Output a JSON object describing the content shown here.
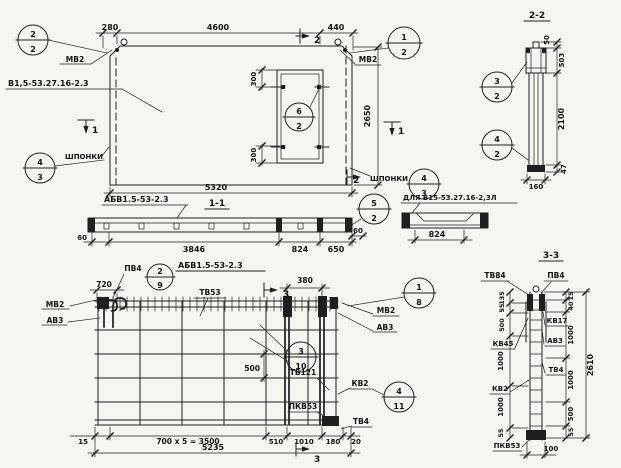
{
  "colors": {
    "ink": "#1f1f1f",
    "paper": "#f6f5f0"
  },
  "plan": {
    "dims": {
      "top_left": "280",
      "top_main": "4600",
      "top_right": "440",
      "right": "2650",
      "bottom": "5320",
      "opening_top": "300",
      "opening_bottom": "300"
    },
    "labels": {
      "anchor_left": "МВ2",
      "anchor_right": "МВ2",
      "panel_mark": "В1,5-53.27.16-2.3",
      "keys_left": "ШПОНКИ",
      "keys_right": "ШПОНКИ"
    },
    "callouts": {
      "top_left": {
        "num": "2",
        "den": "2"
      },
      "top_right": {
        "num": "1",
        "den": "2"
      },
      "keys_left": {
        "num": "4",
        "den": "3"
      },
      "keys_right": {
        "num": "4",
        "den": "3"
      },
      "opening": {
        "num": "6",
        "den": "2"
      }
    },
    "section_marks": {
      "s1": "1",
      "s2": "2"
    }
  },
  "section22": {
    "title": "2-2",
    "dims": {
      "loop": "50",
      "head": "503",
      "stem": "2100",
      "base": "47",
      "width": "160"
    },
    "callouts": {
      "upper": {
        "num": "3",
        "den": "2"
      },
      "lower": {
        "num": "4",
        "den": "2"
      }
    }
  },
  "section11": {
    "title": "1-1",
    "member_mark": "АБВ1.5-53-2.3",
    "dims": {
      "end_left": "60",
      "main": "3846",
      "mid": "824",
      "right_part": "650",
      "end_right": "60"
    },
    "callout": {
      "num": "5",
      "den": "2"
    }
  },
  "detail824": {
    "label": "ДЛЯ В15-53.27.16-2,3Л",
    "dim": "824"
  },
  "reinf": {
    "title": "АБВ1.5-53-2.3",
    "labels": {
      "pv4": "ПВ4",
      "tv53": "ТВ53",
      "mv2_left": "МВ2",
      "av3_left": "АВ3",
      "mv2_right": "МВ2",
      "av3_right": "АВ3",
      "tv121": "ТВ121",
      "kv2": "КВ2",
      "pkv53": "ПКВ53",
      "tv4": "ТВ4"
    },
    "callouts": {
      "hook": {
        "num": "2",
        "den": "9"
      },
      "top_right": {
        "num": "1",
        "den": "8"
      },
      "mid": {
        "num": "3",
        "den": "10"
      },
      "bar": {
        "num": "4",
        "den": "11"
      }
    },
    "dims": {
      "hook": "720",
      "door": "380",
      "inner": "500",
      "left": "15",
      "spacing": "700 x 5 = 3500",
      "a": "510",
      "b": "1010",
      "c": "180",
      "d": "20",
      "total": "5235"
    },
    "section_mark": "3"
  },
  "section33": {
    "title": "3-3",
    "labels": {
      "tv84": "ТВ84",
      "pv4": "ПВ4",
      "kv17": "КВ17",
      "av3": "АВ3",
      "kv45": "КВ45",
      "kv2": "КВ2",
      "tv4": "ТВ4",
      "pkv53": "ПКВ53"
    },
    "left": [
      "135",
      "55",
      "500",
      "1000",
      "1000",
      "55"
    ],
    "right": [
      "15",
      "40",
      "1000",
      "1000",
      "500",
      "55"
    ],
    "total": "2610",
    "width": "100"
  }
}
